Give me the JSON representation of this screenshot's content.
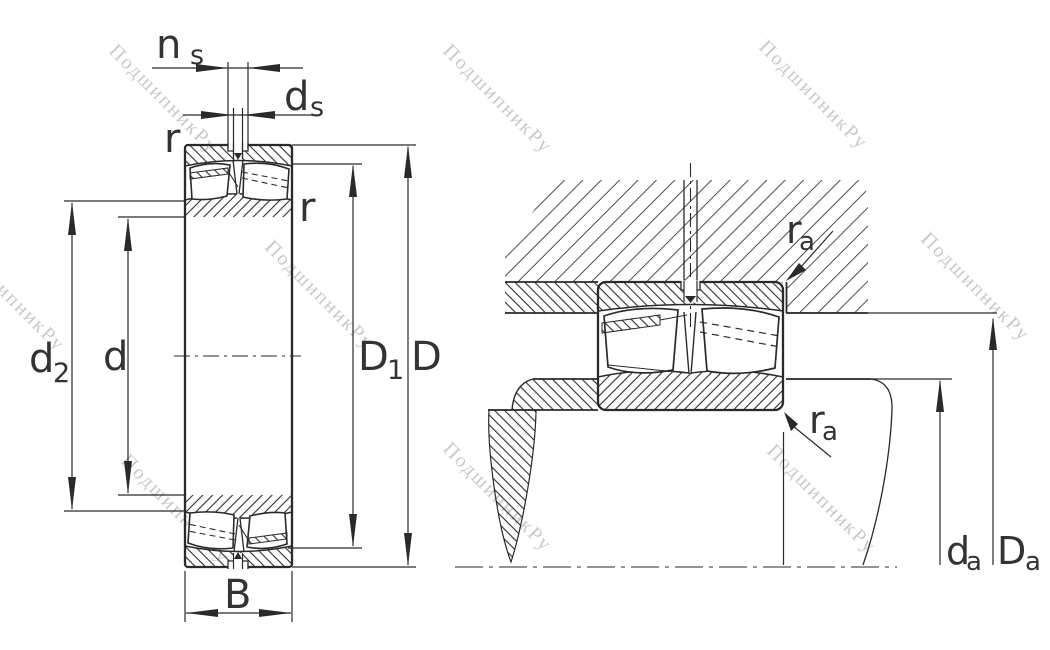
{
  "diagram": {
    "kind": "spherical-roller-bearing-dimension-drawing",
    "views": {
      "left": "bearing cross-section with boundary dimensions",
      "right": "bearing mounted in housing and on shaft with abutment dimensions"
    }
  },
  "watermark": {
    "text": "ПодшипникРу"
  },
  "labels": {
    "ns": {
      "base": "n",
      "sub": "s"
    },
    "ds": {
      "base": "d",
      "sub": "s"
    },
    "r_outer": {
      "base": "r"
    },
    "r_inner": {
      "base": "r"
    },
    "d2": {
      "base": "d",
      "sub": "2"
    },
    "d": {
      "base": "d"
    },
    "D1": {
      "base": "D",
      "sub": "1"
    },
    "D": {
      "base": "D"
    },
    "B": {
      "base": "B"
    },
    "ra_housing": {
      "base": "r",
      "sub": "a"
    },
    "ra_shaft": {
      "base": "r",
      "sub": "a"
    },
    "da": {
      "base": "d",
      "sub": "a"
    },
    "Da": {
      "base": "D",
      "sub": "a"
    }
  },
  "colors": {
    "line": "#2a2a2a",
    "label": "#333333",
    "watermark": "#c9c9c9",
    "hatch_dense": "#2f2f2f",
    "hatch_sparse": "#4d4d4d",
    "background": "#ffffff"
  }
}
